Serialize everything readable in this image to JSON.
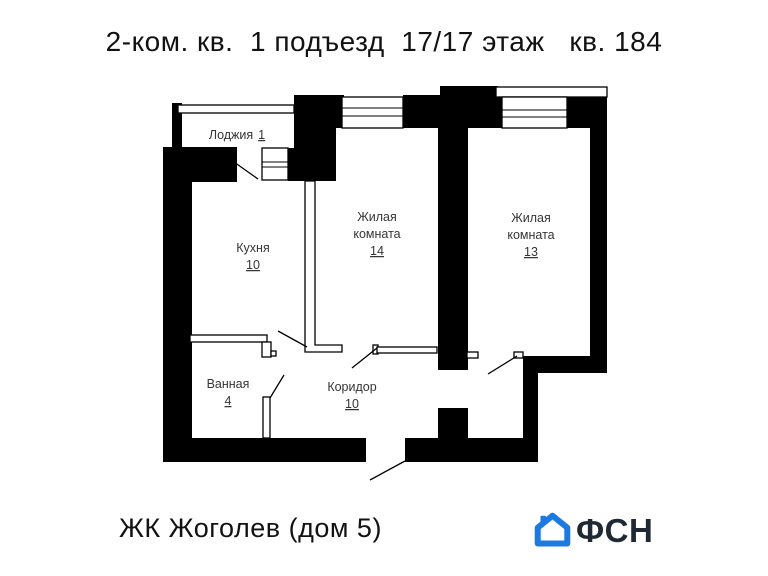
{
  "title": "2-ком. кв.  1 подъезд  17/17 этаж   кв. 184",
  "floorplan": {
    "rooms": [
      {
        "id": "loggia",
        "name": "Лоджия",
        "area": "1"
      },
      {
        "id": "kitchen",
        "name": "Кухня",
        "area": "10"
      },
      {
        "id": "living-14",
        "name_lines": [
          "Жилая",
          "комната"
        ],
        "area": "14"
      },
      {
        "id": "living-13",
        "name_lines": [
          "Жилая",
          "комната"
        ],
        "area": "13"
      },
      {
        "id": "bathroom",
        "name": "Ванная",
        "area": "4"
      },
      {
        "id": "corridor",
        "name": "Коридор",
        "area": "10"
      }
    ]
  },
  "footer": {
    "project": "ЖК Жоголев (дом 5)",
    "logo_text": "ФСН"
  },
  "colors": {
    "walls": "#000000",
    "logo_blue": "#1b79e2",
    "logo_text": "#1f2933"
  }
}
